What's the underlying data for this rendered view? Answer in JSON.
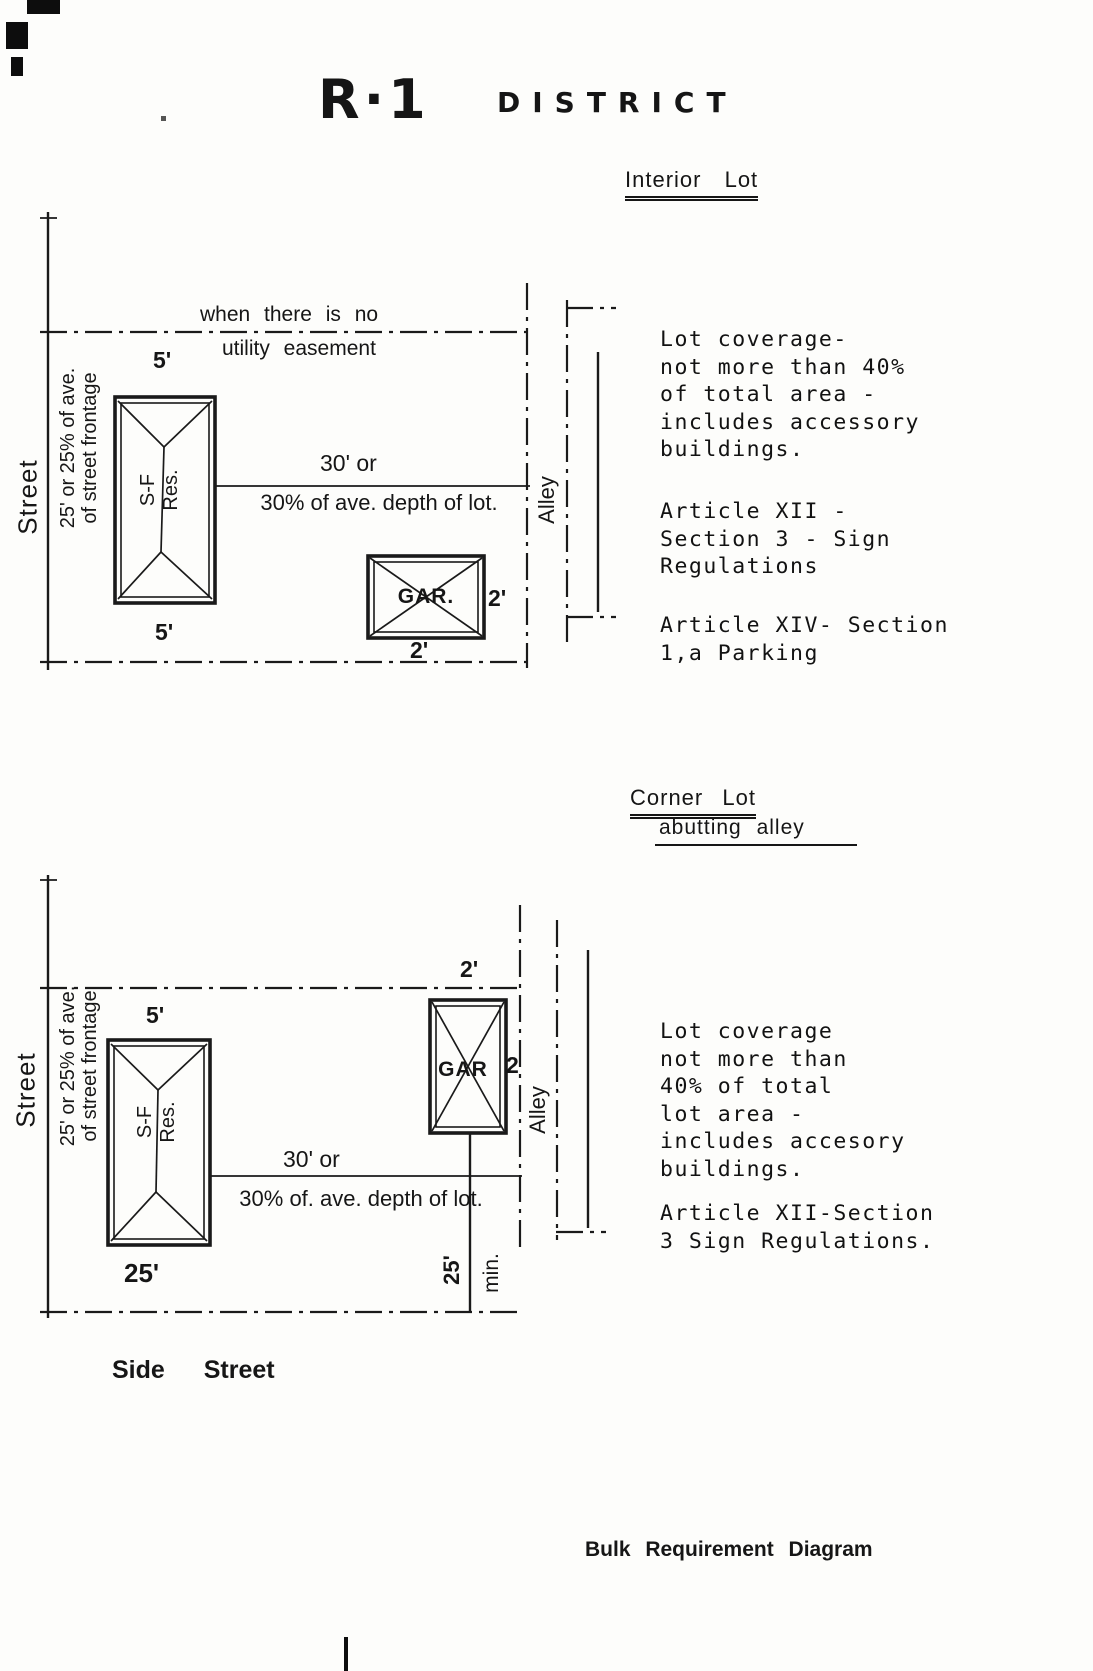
{
  "title": {
    "code": "R·1",
    "word": "DISTRICT"
  },
  "caption": "Bulk Requirement Diagram",
  "interior": {
    "heading": "Interior Lot",
    "easement_line1": "when there is no",
    "easement_line2": "utility easement",
    "street": "Street",
    "frontage": "25' or 25% of ave.\nof street frontage",
    "setback_top": "5'",
    "setback_bottom": "5'",
    "house": "S-F\nRes.",
    "depth_line1": "30' or",
    "depth_line2": "30% of ave. depth of lot.",
    "garage": "GAR.",
    "garage_side": "2'",
    "garage_rear": "2'",
    "alley": "Alley",
    "note_coverage": "Lot coverage-\nnot more than 40%\nof total area -\nincludes accessory\nbuildings.",
    "note_sign": "Article XII -\nSection 3 - Sign\nRegulations",
    "note_parking": "Article XIV- Section\n1,a Parking"
  },
  "corner": {
    "heading": "Corner Lot",
    "subheading": "abutting alley",
    "street": "Street",
    "side_street": "Side Street",
    "frontage": "25' or 25% of ave.\nof street frontage",
    "setback_top": "5'",
    "front_setback": "25'",
    "garage_top": "2'",
    "garage": "GAR",
    "garage_side": "2",
    "house": "S-F\nRes.",
    "depth_line1": "30' or",
    "depth_line2": "30% of. ave. depth of lot.",
    "rear_min_value": "25'",
    "rear_min_unit": "min.",
    "alley": "Alley",
    "note_coverage": "Lot coverage\nnot more than\n40% of total\nlot area -\nincludes accesory\nbuildings.",
    "note_sign": "Article XII-Section\n3 Sign Regulations."
  }
}
